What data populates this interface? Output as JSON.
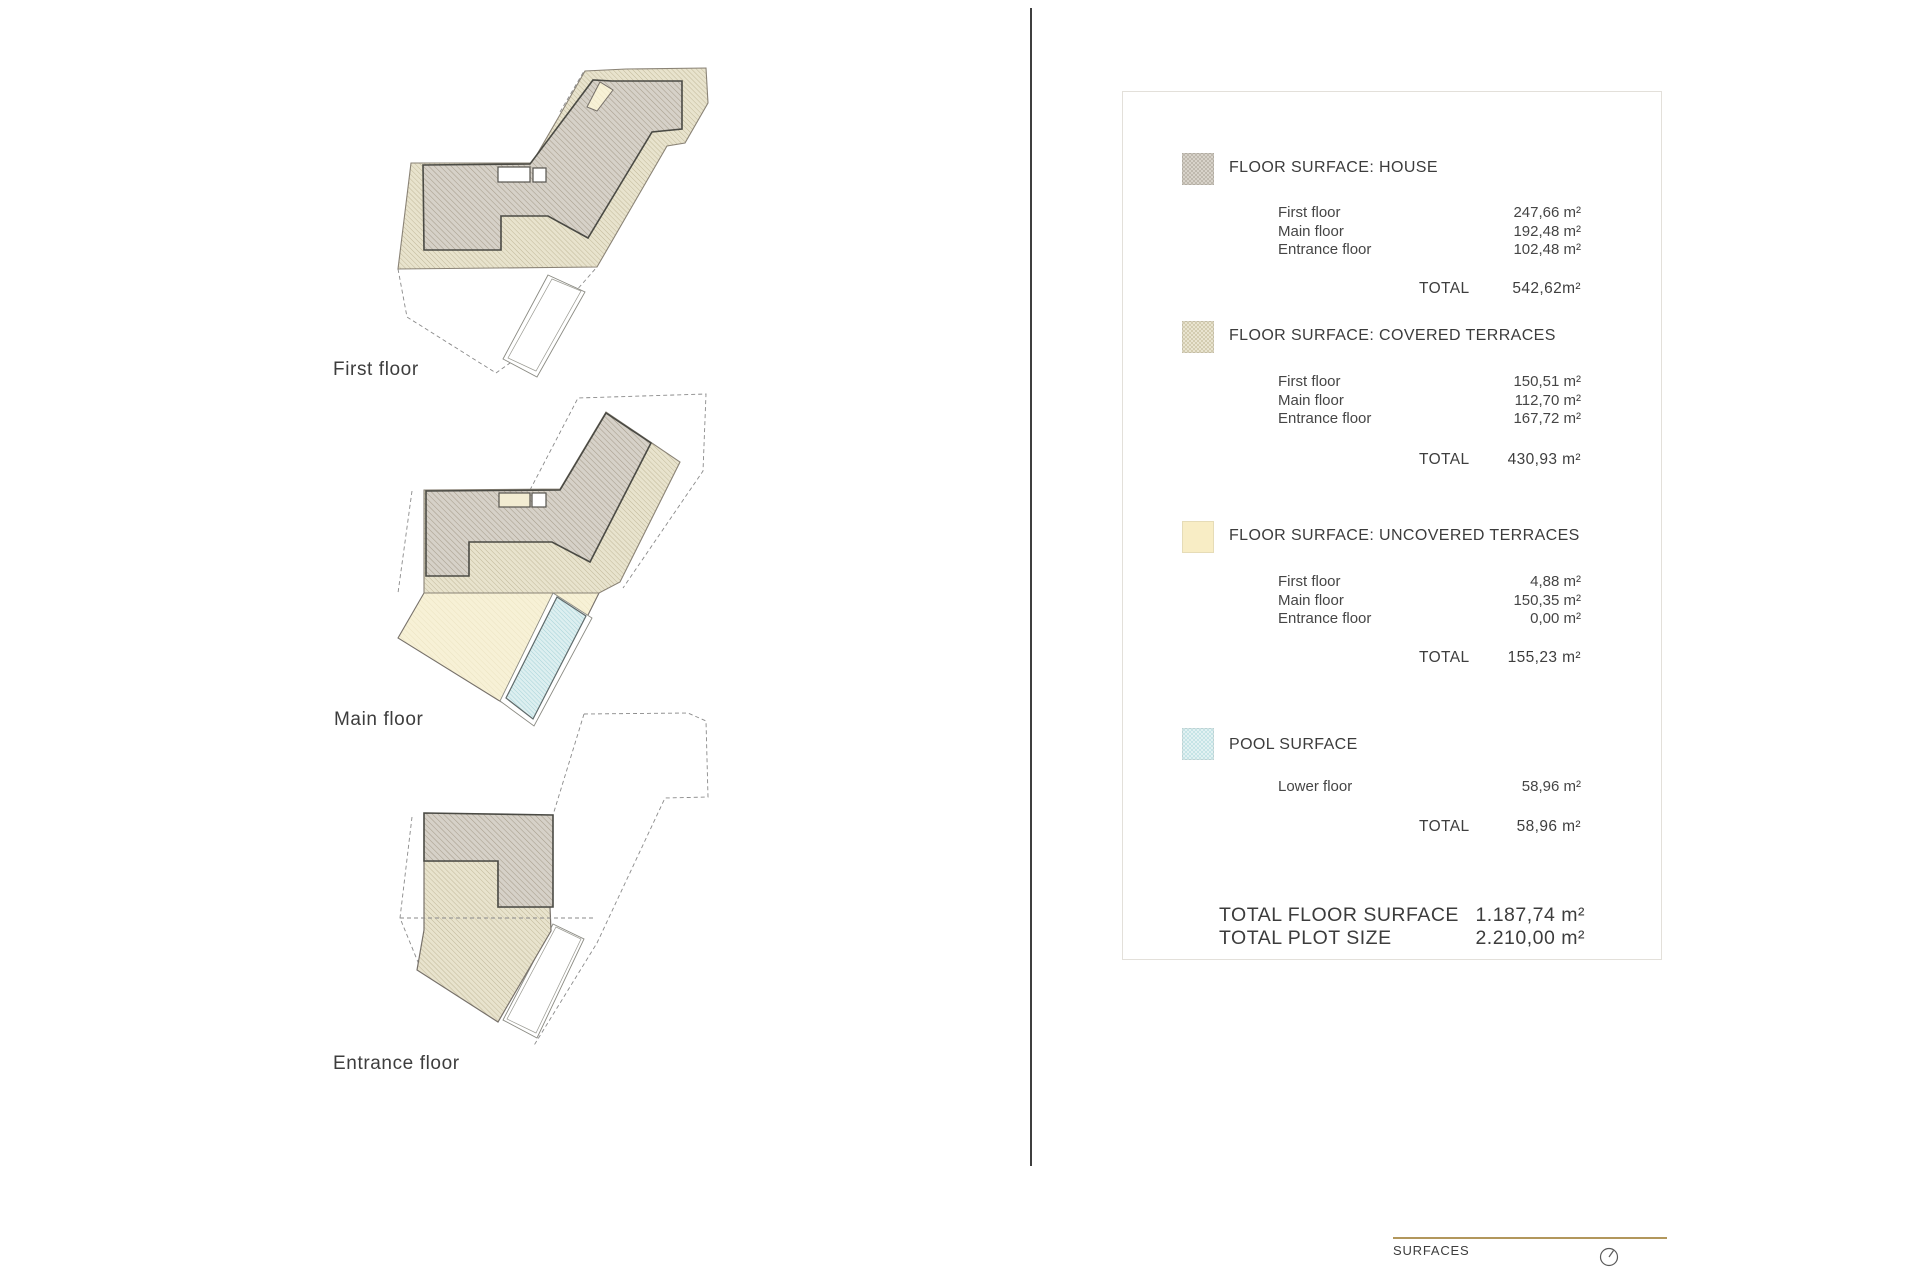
{
  "plans": [
    {
      "label": "First floor"
    },
    {
      "label": "Main floor"
    },
    {
      "label": "Entrance floor"
    }
  ],
  "panel": {
    "sections": [
      {
        "title": "FLOOR SURFACE: HOUSE",
        "rows": [
          {
            "label": "First floor",
            "value": "247,66 m²"
          },
          {
            "label": "Main floor",
            "value": "192,48 m²"
          },
          {
            "label": "Entrance floor",
            "value": "102,48 m²"
          }
        ],
        "total_label": "TOTAL",
        "total_value": "542,62m²"
      },
      {
        "title": "FLOOR SURFACE: COVERED TERRACES",
        "rows": [
          {
            "label": "First floor",
            "value": "150,51 m²"
          },
          {
            "label": "Main floor",
            "value": "112,70 m²"
          },
          {
            "label": "Entrance floor",
            "value": "167,72 m²"
          }
        ],
        "total_label": "TOTAL",
        "total_value": "430,93 m²"
      },
      {
        "title": "FLOOR SURFACE: UNCOVERED TERRACES",
        "rows": [
          {
            "label": "First floor",
            "value": "4,88 m²"
          },
          {
            "label": "Main floor",
            "value": "150,35 m²"
          },
          {
            "label": "Entrance floor",
            "value": "0,00 m²"
          }
        ],
        "total_label": "TOTAL",
        "total_value": "155,23 m²"
      },
      {
        "title": "POOL SURFACE",
        "rows": [
          {
            "label": "Lower floor",
            "value": "58,96 m²"
          }
        ],
        "total_label": "TOTAL",
        "total_value": "58,96 m²"
      }
    ],
    "grand_totals": [
      {
        "label": "TOTAL FLOOR SURFACE",
        "value": "1.187,74 m²"
      },
      {
        "label": "TOTAL PLOT SIZE",
        "value": "2.210,00 m²"
      }
    ]
  },
  "footer": {
    "label": "SURFACES"
  },
  "colors": {
    "house_swatch": "#cac5bb",
    "covered_swatch": "#ddd7c0",
    "uncovered_swatch": "#f8edc5",
    "pool_swatch": "#d5ebec",
    "accent_line": "#b2975c",
    "ink": "#474747"
  }
}
